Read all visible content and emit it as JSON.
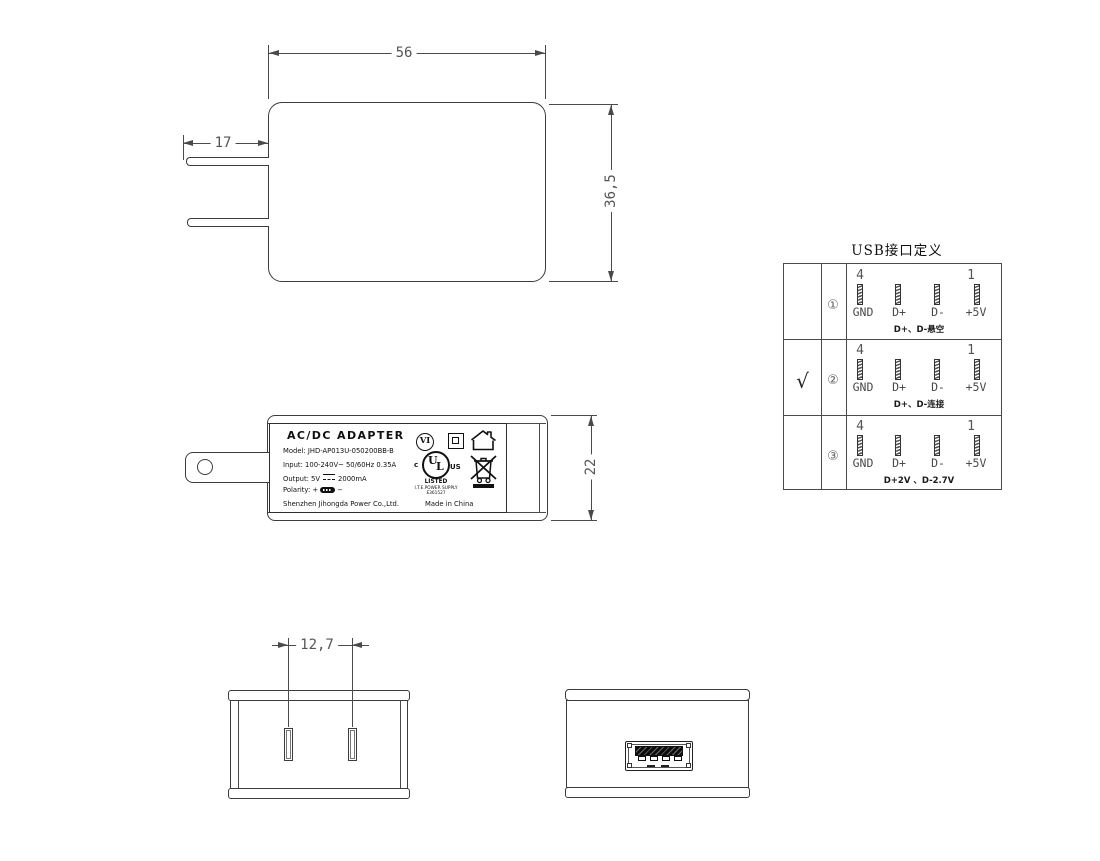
{
  "views": {
    "front": {
      "width_dim": "56",
      "height_dim": "36,5",
      "prong_dim": "17"
    },
    "side": {
      "thickness_dim": "22",
      "label": {
        "title": "AC/DC  ADAPTER",
        "model": "Model: JHD-AP013U-050200BB-B",
        "input": "Input: 100-240V~  50/60Hz  0.35A",
        "output_prefix": "Output: 5V",
        "output_suffix": "2000mA",
        "polarity_prefix": "Polarity:",
        "polarity_plus": "+",
        "polarity_minus": "−",
        "company": "Shenzhen Jihongda Power Co.,Ltd.",
        "made_in": "Made in China",
        "efficiency_mark": "VI",
        "ul_c": "c",
        "ul_u": "U",
        "ul_l": "L",
        "ul_us": "US",
        "ul_listed": "LISTED",
        "ul_type": "I.T.E.POWER SUPPLY",
        "ul_file": "E361527"
      }
    },
    "bottom_front": {
      "pin_spacing_dim": "12,7"
    },
    "usb_table": {
      "title": "USB接口定义",
      "pin_num_left": "4",
      "pin_num_right": "1",
      "pin_labels": [
        "GND",
        "D+",
        "D-",
        "+5V"
      ],
      "rows": [
        {
          "check": "",
          "num": "①",
          "note": "D+、D-悬空"
        },
        {
          "check": "√",
          "num": "②",
          "note": "D+、D-连接"
        },
        {
          "check": "",
          "num": "③",
          "note": "D+2V 、D-2.7V"
        }
      ]
    }
  }
}
